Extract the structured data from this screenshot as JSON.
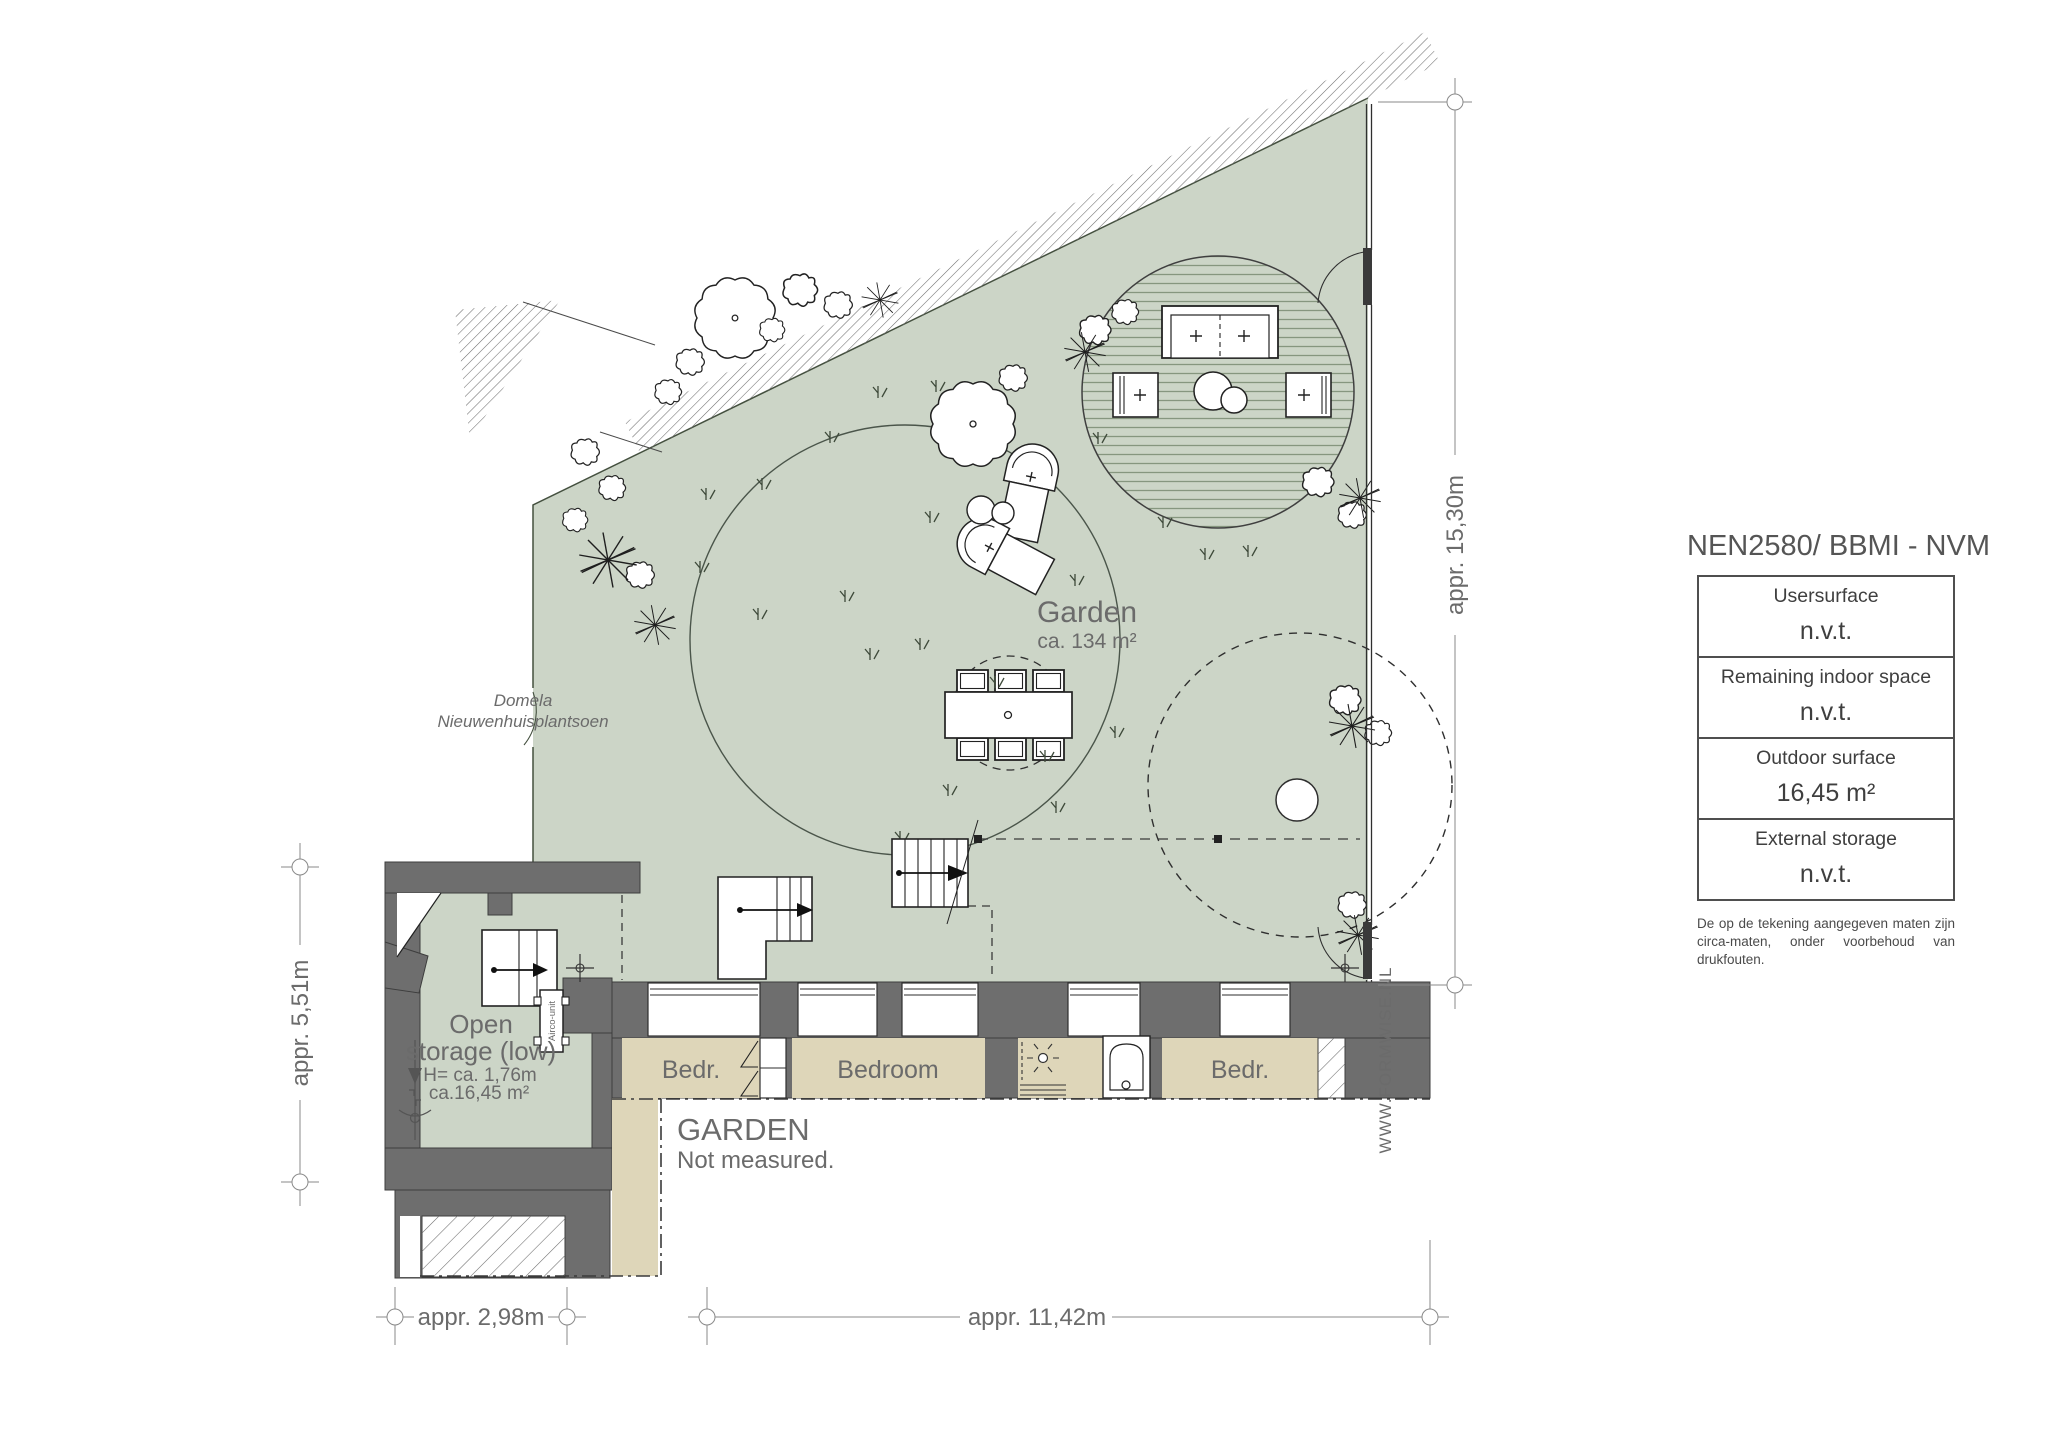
{
  "colors": {
    "garden_green": "#ccd5c7",
    "wall_gray": "#6e6e6e",
    "floor_beige": "#ded6b9",
    "dim_gray": "#8a8a8a",
    "text_gray": "#6b6b6b",
    "watermark_gray": "#9b9b9b"
  },
  "plan": {
    "garden": {
      "label": "Garden",
      "area": "ca. 134 m²"
    },
    "park_label": {
      "line1": "Domela",
      "line2": "Nieuwenhuisplantsoen"
    },
    "storage": {
      "line1": "Open",
      "line2": "storage (low)",
      "height": "H= ca. 1,76m",
      "area": "ca.16,45 m²",
      "airco": "Airco-unit"
    },
    "garden_south": {
      "title": "GARDEN",
      "subtitle": "Not measured."
    },
    "rooms": {
      "bedr_left": "Bedr.",
      "bedroom": "Bedroom",
      "bedr_right": "Bedr."
    },
    "watermark": "WWW.FORMWISE.NL"
  },
  "dimensions": {
    "right": "appr. 15,30m",
    "left": "appr. 5,51m",
    "bottom_left": "appr. 2,98m",
    "bottom_center": "appr. 11,42m"
  },
  "title_block": {
    "title": "NEN2580/ BBMI - NVM",
    "rows": [
      {
        "label": "Usersurface",
        "value": "n.v.t."
      },
      {
        "label": "Remaining indoor space",
        "value": "n.v.t."
      },
      {
        "label": "Outdoor surface",
        "value": "16,45 m²"
      },
      {
        "label": "External storage",
        "value": "n.v.t."
      }
    ],
    "disclaimer": "De op de tekening aangegeven maten zijn circa-maten, onder voorbehoud van drukfouten."
  }
}
